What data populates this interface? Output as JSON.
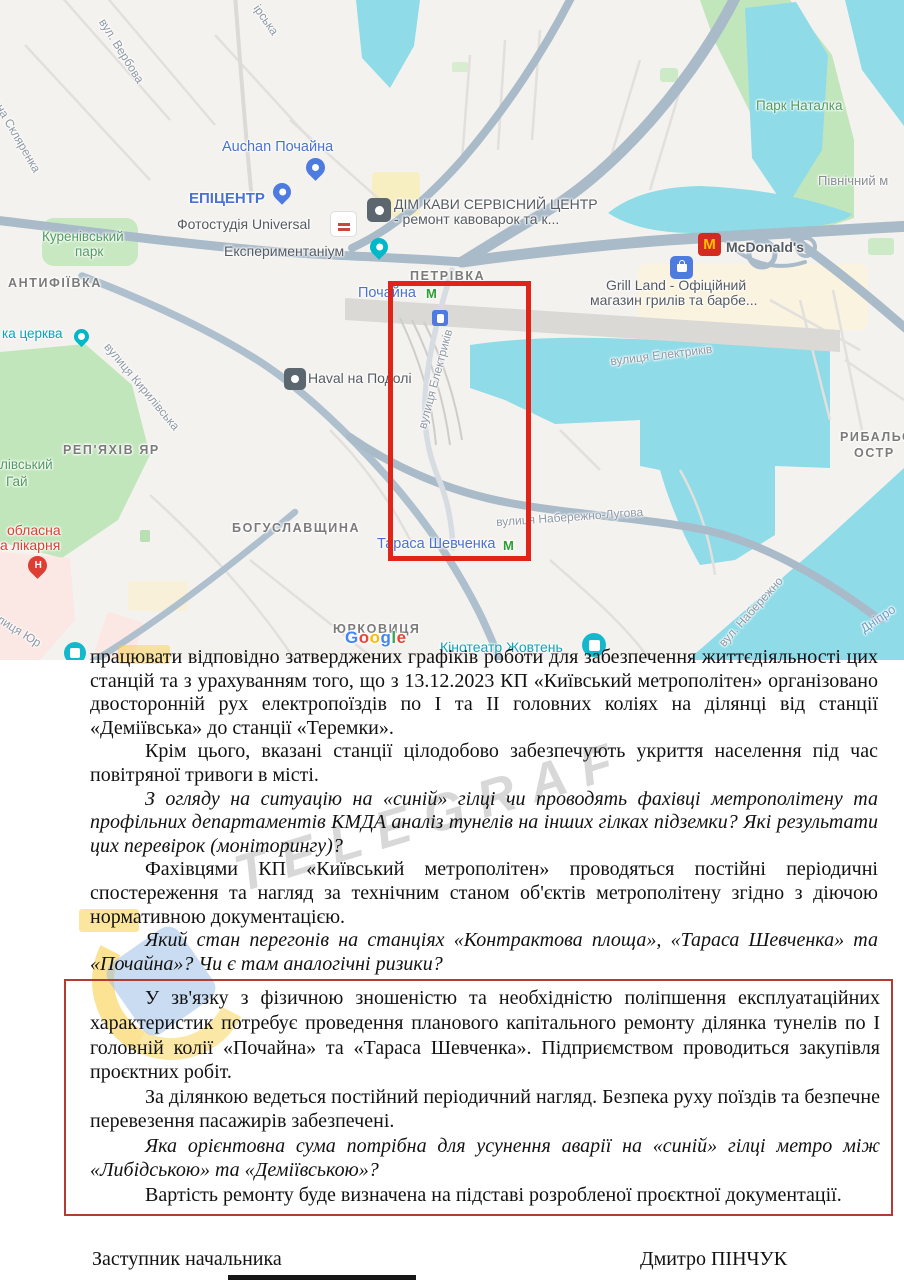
{
  "map": {
    "labels": {
      "irska": "ірська",
      "verbova": "вул. Вербова",
      "sklyarenka": "ена Скляренка",
      "park_natalka": "Парк Наталка",
      "pivnichnyi": "Північний м",
      "auchan": "Auchan Почайна",
      "epicentr": "ЕПІЦЕНТР",
      "fotostudiia": "Фотостудія Universal",
      "dim_kavy_line1": "ДІМ КАВИ СЕРВІСНИЙ ЦЕНТР",
      "dim_kavy_line2": "- ремонт кавоварок та к...",
      "eksperymentanium": "Експериментаніум",
      "kurenivskyi_line1": "Куренівський",
      "kurenivskyi_line2": "парк",
      "antyfiivka": "АНТИФІЇВКА",
      "petrivka": "ПЕТРІВКА",
      "pochaina": "Почайна",
      "mcdonalds": "McDonald's",
      "grill_line1": "Grill Land - Офіційний",
      "grill_line2": "магазин грилів та барбе...",
      "elektrykiv_a": "вулиця Електриків",
      "elektrykiv_b": "вулиця Електриків",
      "haval": "Haval на Подолі",
      "kyrylivska": "вулиця Кирилівська",
      "tserkva": "ка церква",
      "repiakhiv_yar": "РЕП'ЯХІВ ЯР",
      "hai_line1": "лівський",
      "hai_line2": "Гай",
      "oblasna_line1": "обласна",
      "oblasna_line2": "а лікарня",
      "bohuslavshchyna": "БОГУСЛАВЩИНА",
      "naberezhno": "вулиця Набережно-Лугова",
      "naberezhno_b": "вул. Набережно",
      "taras_shevchenka": "Тараса Шевченка",
      "yurkovytsia": "ЮРКОВИЦЯ",
      "kinoteatr": "Кінотеатр Жовтень",
      "vul_yur": "лиця Юр",
      "rybalskyi_line1": "РИБАЛЬС",
      "rybalskyi_line2": "ОСТР",
      "dnipro": "Дніпро"
    },
    "icons": {
      "metro_letter": "М",
      "mcdonalds_letter": "M",
      "hospital_letter": "Н"
    },
    "attribution_letters": [
      "G",
      "o",
      "o",
      "g",
      "l",
      "e"
    ],
    "colors": {
      "annotation_rect": "#e02418",
      "water": "#8fdbe8",
      "park": "#c2e6bc",
      "road": "#a9bac9",
      "label_blue": "#4a73d1",
      "label_teal": "#0aa5b8",
      "label_green": "#509b60",
      "label_red": "#dd3d33"
    }
  },
  "document": {
    "paragraphs": [
      {
        "text": "працювати відповідно затверджених графіків роботи для забезпечення життєдіяльності цих станцій та з урахуванням того, що з 13.12.2023 КП «Київський метрополітен» організовано двосторонній рух електропоїздів по І та ІІ головних коліях на ділянці від станції «Деміївська» до станції «Теремки»."
      },
      {
        "text": "Крім цього, вказані станції цілодобово забезпечують укриття населення під час повітряної тривоги в місті."
      },
      {
        "text": "З огляду на ситуацію на «синій» гілці чи проводять фахівці метрополітену та профільних департаментів КМДА аналіз тунелів на інших гілках підземки? Які результати цих перевірок (моніторингу)?"
      },
      {
        "text": "Фахівцями КП «Київський метрополітен» проводяться постійні періодичні спостереження та нагляд за технічним станом об'єктів метрополітену згідно з діючою нормативною документацією."
      },
      {
        "text": "Який стан перегонів на станціях «Контрактова площа», «Тараса Шевченка» та «Почайна»? Чи є там аналогічні ризики?"
      }
    ],
    "boxed_paragraphs": [
      {
        "text": "У зв'язку з фізичною зношеністю та необхідністю поліпшення експлуатаційних характеристик потребує проведення планового капітального ремонту ділянка тунелів по І головній колії «Почайна» та «Тараса Шевченка». Підприємством проводиться закупівля проєктних робіт."
      },
      {
        "text": "За ділянкою ведеться постійний періодичний нагляд. Безпека руху поїздів та безпечне перевезення пасажирів забезпечені."
      },
      {
        "text": "Яка орієнтовна сума потрібна для усунення аварії на «синій» гілці метро між «Либідською» та «Деміївською»?"
      },
      {
        "text": "Вартість ремонту буде визначена на підставі розробленої проєктної документації."
      }
    ],
    "signature_left": "Заступник начальника",
    "signature_right": "Дмитро ПІНЧУК"
  },
  "watermark": {
    "text": "TELEGRAF"
  }
}
